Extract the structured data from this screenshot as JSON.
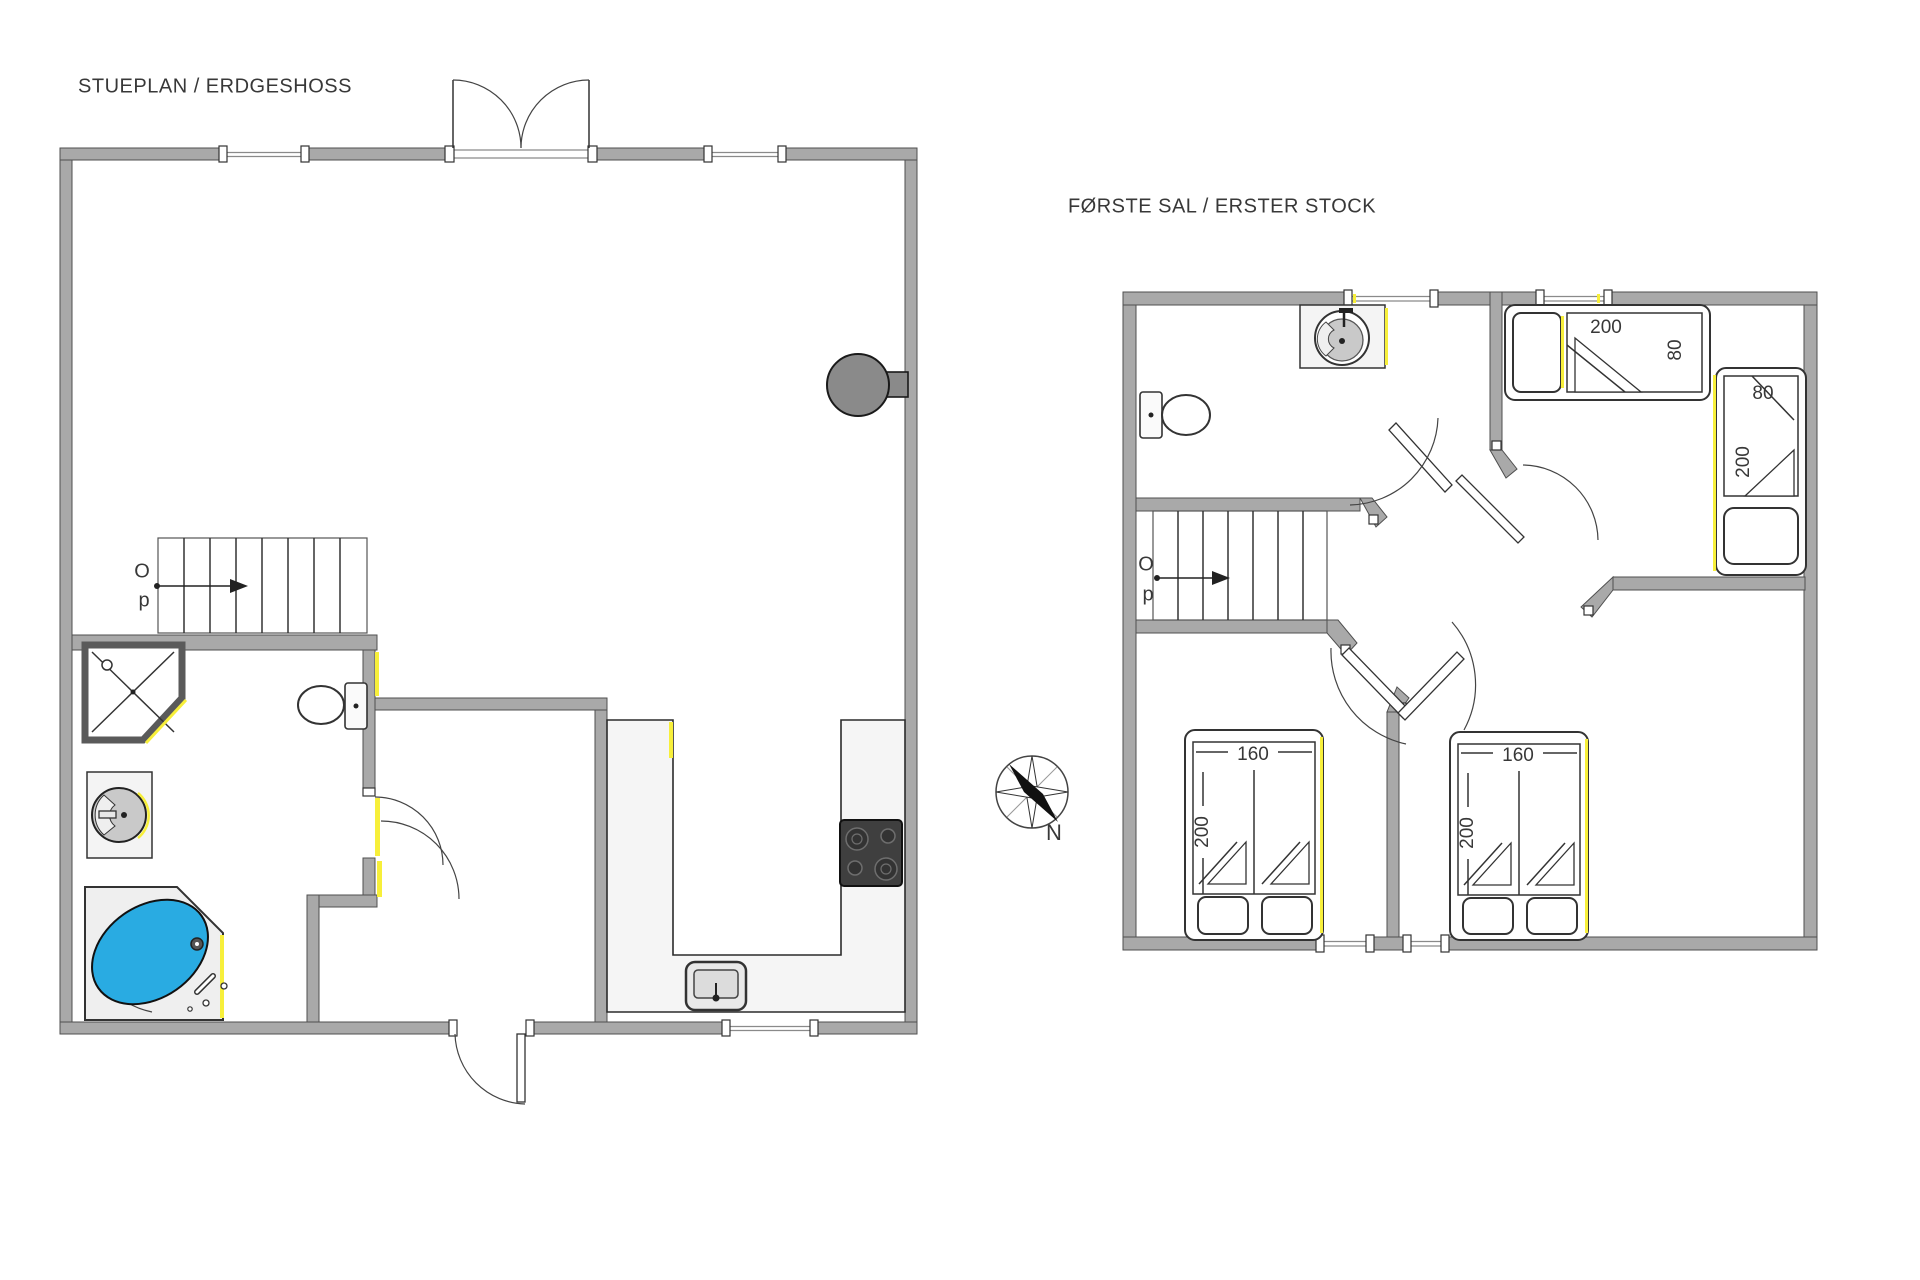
{
  "colors": {
    "wall": "#a9a9a9",
    "wall_stroke": "#4f4f4f",
    "water": "#29abe2",
    "accent": "#f7ef3a",
    "counter": "#f4f4f4",
    "appliance": "#3f3f3f",
    "fireplace": "#8a8a8a",
    "text": "#383838"
  },
  "ground_floor": {
    "title": "STUEPLAN / ERDGESHOSS",
    "stairs": {
      "up_letter_1": "O",
      "up_letter_2": "p"
    }
  },
  "first_floor": {
    "title": "FØRSTE SAL / ERSTER STOCK",
    "stairs": {
      "up_letter_1": "O",
      "up_letter_2": "p"
    },
    "bed_single_top": {
      "length": "200",
      "width": "80"
    },
    "bed_single_right": {
      "width": "80",
      "length": "200"
    },
    "bed_double_left": {
      "width": "160",
      "length": "200"
    },
    "bed_double_right": {
      "width": "160",
      "length": "200"
    }
  },
  "compass": {
    "north": "N"
  }
}
